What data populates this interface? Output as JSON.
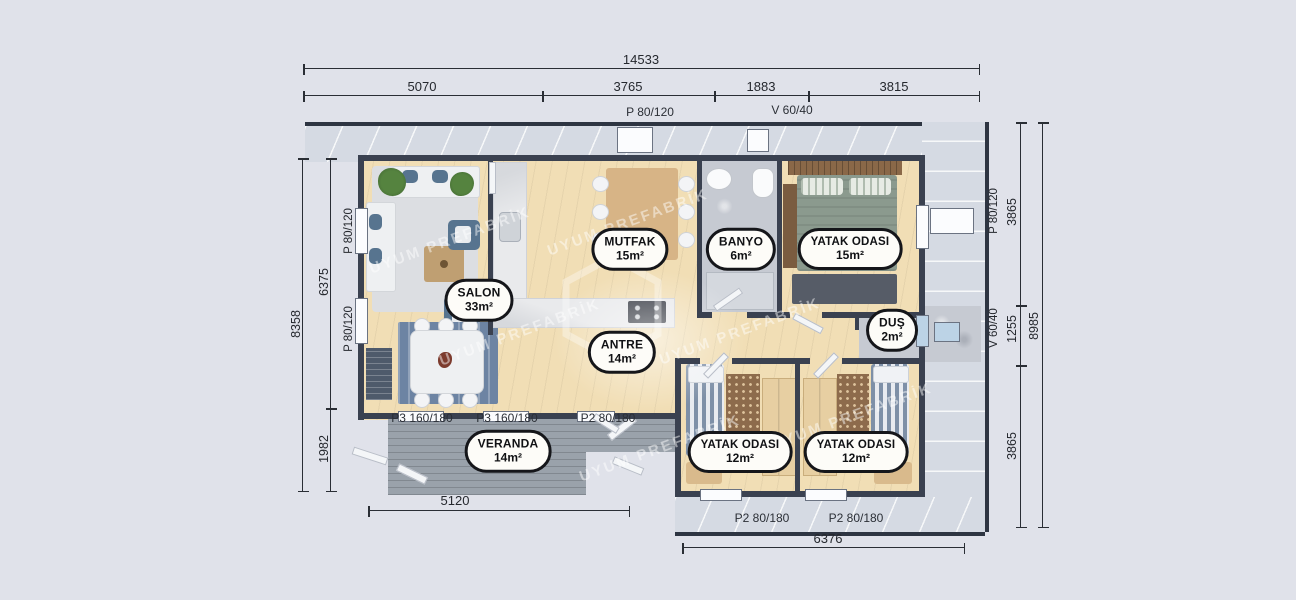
{
  "watermark": {
    "text": "UYUM PREFABRİK"
  },
  "rooms": {
    "mutfak": {
      "name": "MUTFAK",
      "area": "15m²"
    },
    "banyo": {
      "name": "BANYO",
      "area": "6m²"
    },
    "yatak1": {
      "name": "YATAK ODASI",
      "area": "15m²"
    },
    "salon": {
      "name": "SALON",
      "area": "33m²"
    },
    "dus": {
      "name": "DUŞ",
      "area": "2m²"
    },
    "antre": {
      "name": "ANTRE",
      "area": "14m²"
    },
    "veranda": {
      "name": "VERANDA",
      "area": "14m²"
    },
    "yatak2": {
      "name": "YATAK ODASI",
      "area": "12m²"
    },
    "yatak3": {
      "name": "YATAK ODASI",
      "area": "12m²"
    }
  },
  "dims": {
    "top": {
      "total": "14533",
      "segments": [
        "5070",
        "3765",
        "1883",
        "3815"
      ]
    },
    "left": {
      "total": "8358",
      "segments": [
        "6375",
        "1982"
      ]
    },
    "right": {
      "total": "8985",
      "segments": [
        "3865",
        "1255",
        "3865"
      ]
    },
    "bottom": {
      "veranda": "5120",
      "bedrooms": "6376"
    }
  },
  "openings": {
    "top_door": "P 80/120",
    "top_vent": "V 60/40",
    "left_window_1": "P 80/120",
    "left_window_2": "P 80/120",
    "right_window": "P 80/120",
    "right_vent": "V 60/40",
    "veranda_1": "P3 160/180",
    "veranda_2": "P3 160/180",
    "veranda_3": "P2 80/180",
    "door_1": "P2 80/180",
    "door_2": "P2 80/180"
  },
  "colors": {
    "background": "#e0e2ea",
    "roof_panel": "#d5dae3",
    "wall": "#3a4150",
    "wood_floor": "#f1deb5",
    "deck": "#9aa2ab",
    "accent_blue": "#57748f",
    "badge_border": "#15161a"
  }
}
